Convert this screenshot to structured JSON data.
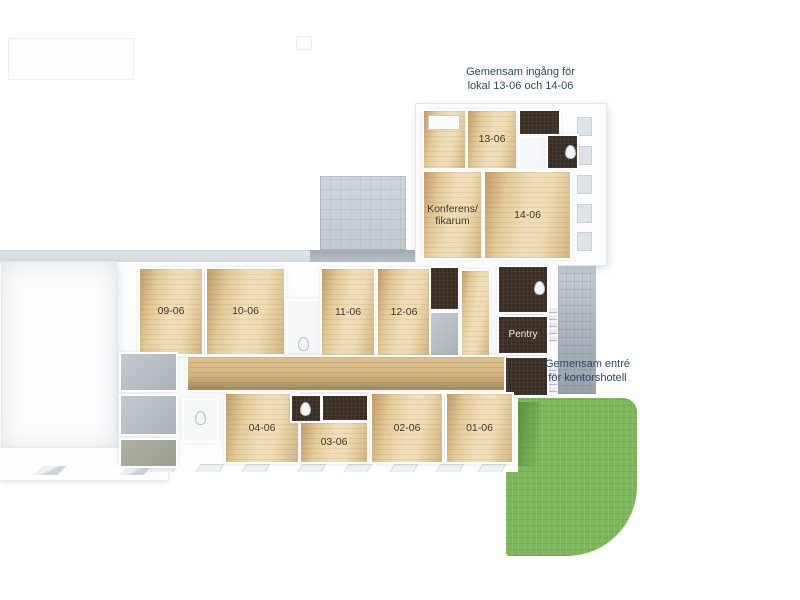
{
  "annotations": {
    "upper_entrance": {
      "line1": "Gemensam ingång för",
      "line2": "lokal 13-06 och 14-06"
    },
    "main_entrance": {
      "line1": "Gemensam entré",
      "line2": "för kontorshotell"
    }
  },
  "colors": {
    "annotation_text": "#2d4a63",
    "room_label_text": "#46321d",
    "pentry_label_text": "#e9ebed",
    "wood_floor_light": "#f0debb",
    "wood_floor_dark": "#c29c68",
    "dark_floor": "#3a2e24",
    "terrace_tile": "#c7d0d7",
    "entry_tile": "#aab4bb",
    "grass": "#7cb85a",
    "grass_shadow": "#5c8f40",
    "wall_white": "#fdfdfe"
  },
  "rooms": [
    {
      "id": "upper-store-room",
      "floor": "wood",
      "x": 424,
      "y": 111,
      "w": 41,
      "h": 57,
      "features": [
        {
          "type": "desk",
          "x": 4,
          "y": 4,
          "w": 30,
          "h": 13
        }
      ]
    },
    {
      "id": "room-13-06",
      "label": "13-06",
      "floor": "wood",
      "x": 468,
      "y": 111,
      "w": 48,
      "h": 57
    },
    {
      "id": "upper-hall",
      "floor": "dark",
      "x": 520,
      "y": 111,
      "w": 39,
      "h": 23
    },
    {
      "id": "upper-lobby",
      "floor": "white",
      "x": 520,
      "y": 138,
      "w": 25,
      "h": 30
    },
    {
      "id": "upper-wc",
      "floor": "dark",
      "x": 548,
      "y": 136,
      "w": 29,
      "h": 32,
      "features": [
        {
          "type": "toilet",
          "x": 17,
          "y": 9
        }
      ]
    },
    {
      "id": "room-konferens",
      "label_lines": [
        "Konferens/",
        "fikarum"
      ],
      "floor": "wood",
      "x": 424,
      "y": 172,
      "w": 57,
      "h": 86
    },
    {
      "id": "room-14-06",
      "label": "14-06",
      "floor": "wood",
      "x": 485,
      "y": 172,
      "w": 85,
      "h": 86
    },
    {
      "id": "room-09-06",
      "label": "09-06",
      "floor": "wood",
      "x": 140,
      "y": 269,
      "w": 62,
      "h": 85
    },
    {
      "id": "room-10-06",
      "label": "10-06",
      "floor": "wood",
      "x": 207,
      "y": 269,
      "w": 77,
      "h": 85
    },
    {
      "id": "utility-wc-mid",
      "floor": "white",
      "x": 288,
      "y": 301,
      "w": 31,
      "h": 55,
      "features": [
        {
          "type": "toilet",
          "x": 10,
          "y": 36
        }
      ]
    },
    {
      "id": "room-11-06",
      "label": "11-06",
      "floor": "wood",
      "x": 322,
      "y": 269,
      "w": 52,
      "h": 86
    },
    {
      "id": "room-12-06",
      "label": "12-06",
      "floor": "wood",
      "x": 378,
      "y": 269,
      "w": 52,
      "h": 86
    },
    {
      "id": "store-dark",
      "floor": "dark",
      "x": 431,
      "y": 268,
      "w": 27,
      "h": 41
    },
    {
      "id": "store-gray",
      "floor": "gray",
      "x": 431,
      "y": 313,
      "w": 27,
      "h": 42
    },
    {
      "id": "wood-cell",
      "floor": "wood",
      "x": 462,
      "y": 271,
      "w": 27,
      "h": 84
    },
    {
      "id": "pentry-upper",
      "floor": "dark",
      "x": 499,
      "y": 267,
      "w": 48,
      "h": 45,
      "features": [
        {
          "type": "toilet",
          "x": 35,
          "y": 14
        }
      ]
    },
    {
      "id": "room-pentry",
      "label": "Pentry",
      "floor": "dark",
      "light_label": true,
      "x": 499,
      "y": 317,
      "w": 48,
      "h": 36
    },
    {
      "id": "pentry-lower",
      "floor": "dark",
      "x": 499,
      "y": 358,
      "w": 48,
      "h": 37
    },
    {
      "id": "corridor",
      "floor": "wood2",
      "x": 188,
      "y": 357,
      "w": 316,
      "h": 33
    },
    {
      "id": "wc-west",
      "floor": "white",
      "x": 184,
      "y": 400,
      "w": 33,
      "h": 41,
      "features": [
        {
          "type": "toilet",
          "x": 11,
          "y": 11
        }
      ]
    },
    {
      "id": "room-04-06",
      "label": "04-06",
      "floor": "wood",
      "x": 226,
      "y": 394,
      "w": 72,
      "h": 68
    },
    {
      "id": "wc-mid-a",
      "floor": "dark",
      "x": 292,
      "y": 396,
      "w": 28,
      "h": 25,
      "features": [
        {
          "type": "toilet",
          "x": 8,
          "y": 6
        }
      ]
    },
    {
      "id": "wc-mid-b",
      "floor": "dark",
      "x": 323,
      "y": 396,
      "w": 44,
      "h": 24
    },
    {
      "id": "room-03-06",
      "label": "03-06",
      "floor": "wood",
      "x": 301,
      "y": 423,
      "w": 66,
      "h": 39
    },
    {
      "id": "room-02-06",
      "label": "02-06",
      "floor": "wood",
      "x": 372,
      "y": 394,
      "w": 70,
      "h": 68
    },
    {
      "id": "room-01-06",
      "label": "01-06",
      "floor": "wood",
      "x": 447,
      "y": 394,
      "w": 65,
      "h": 68
    },
    {
      "id": "shelf-cell-1",
      "floor": "gray",
      "x": 121,
      "y": 354,
      "w": 55,
      "h": 36
    },
    {
      "id": "shelf-cell-2",
      "floor": "gray",
      "x": 121,
      "y": 396,
      "w": 55,
      "h": 38
    },
    {
      "id": "shelf-cell-3",
      "floor": "gray2",
      "x": 121,
      "y": 440,
      "w": 55,
      "h": 26
    }
  ]
}
